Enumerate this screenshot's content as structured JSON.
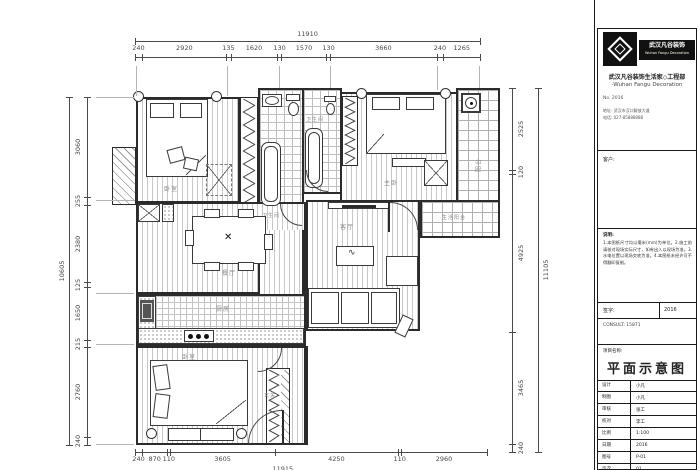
{
  "meta": {
    "paper": "#ffffff",
    "line": "#2b2b2b",
    "pattern": "#c8c8c8",
    "dim": "#4a4a4a"
  },
  "dims": {
    "top": {
      "overall": "11910",
      "segments": [
        "240",
        "2920",
        "135",
        "1620",
        "130",
        "1570",
        "130",
        "3660",
        "240",
        "1265"
      ]
    },
    "left": {
      "overall": "10605",
      "segments": [
        "3060",
        "255",
        "2380",
        "125",
        "1650",
        "215",
        "2760",
        "240"
      ]
    },
    "right": {
      "overall": "11105",
      "segments": [
        "2525",
        "120",
        "4925",
        "3465",
        "240"
      ]
    },
    "bottom": {
      "overall": "11915",
      "segments": [
        "240",
        "870",
        "110",
        "3605",
        "4250",
        "110",
        "2960"
      ]
    }
  },
  "rooms": {
    "bedroom_top": "卧室",
    "bath_a": "卫生间",
    "bath_b": "卫生间",
    "master": "主卧",
    "balcony_top": "阳台",
    "balcony_mid": "生活阳台",
    "dining": "餐厅",
    "living": "客厅",
    "kitchen": "厨房",
    "bedroom_bottom": "卧室",
    "entry": "玄关",
    "fan_mark": "✕",
    "table_squiggle": "∿"
  },
  "titleblock": {
    "logo_cn": "武汉凡谷装饰",
    "logo_en": "Wuhan Fangu Decoration",
    "header_cn": "武汉凡谷装饰生活家◇工程部",
    "header_en": "-Wuhan Fangu Decoration",
    "no_line": "No. 2016",
    "addr": "地址: 武汉市汉口解放大道",
    "tel": "电话: 027-85888888",
    "client_label": "客户:",
    "notes_title": "说明:",
    "notes": "1.本图纸尺寸均以毫米(mm)为单位。2.施工前请核对现场实际尺寸，如有出入以现场为准。3.水电位置以现场交底为准。4.本图纸未经许可不得翻印复制。",
    "sign_label": "签字:",
    "sign_value": "2016",
    "consult": "CONSULT: 15871",
    "project_label": "项目名称:",
    "drawing_title": "平面示意图",
    "table": {
      "r0": {
        "l": "设计",
        "v": "小凡"
      },
      "r1": {
        "l": "制图",
        "v": "小凡"
      },
      "r2": {
        "l": "审核",
        "v": "张工"
      },
      "r3": {
        "l": "校对",
        "v": "李工"
      },
      "r4": {
        "l": "比例",
        "v": "1:100"
      },
      "r5": {
        "l": "日期",
        "v": "2016"
      },
      "r6": {
        "l": "图号",
        "v": "P-01"
      },
      "r7": {
        "l": "页次",
        "v": "01"
      }
    }
  }
}
